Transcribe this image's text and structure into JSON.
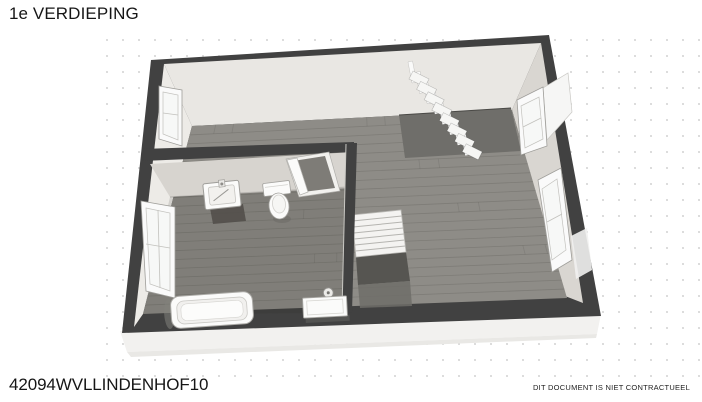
{
  "page": {
    "title": "1e VERDIEPING",
    "code": "42094WVLLINDENHOF10",
    "disclaimer": "DIT DOCUMENT IS NIET CONTRACTUEEL"
  },
  "colors": {
    "background": "#ffffff",
    "grid_dot": "#d6d6d6",
    "wall_dark": "#414141",
    "slab": "#f2f1ef",
    "face_top": "#e9e7e3",
    "face_left": "#edebe7",
    "face_right": "#d9d6d1",
    "face_interior": "#d7d4cf",
    "floor": "#8e8c87",
    "floor_opening_dark": "#7e7c77",
    "bath_floor_shade": "rgba(40,38,34,0.13)",
    "plank_seam": "rgba(45,43,40,0.16)",
    "stairwell": "#6f6e6a",
    "stair_shadow_dark": "#565551",
    "stair_shadow_mid": "#6e6d68",
    "fixture_white": "#fbfbfa",
    "fixture_stroke": "#a6a5a1",
    "glass": "#f7f8f7",
    "text": "#161616"
  }
}
